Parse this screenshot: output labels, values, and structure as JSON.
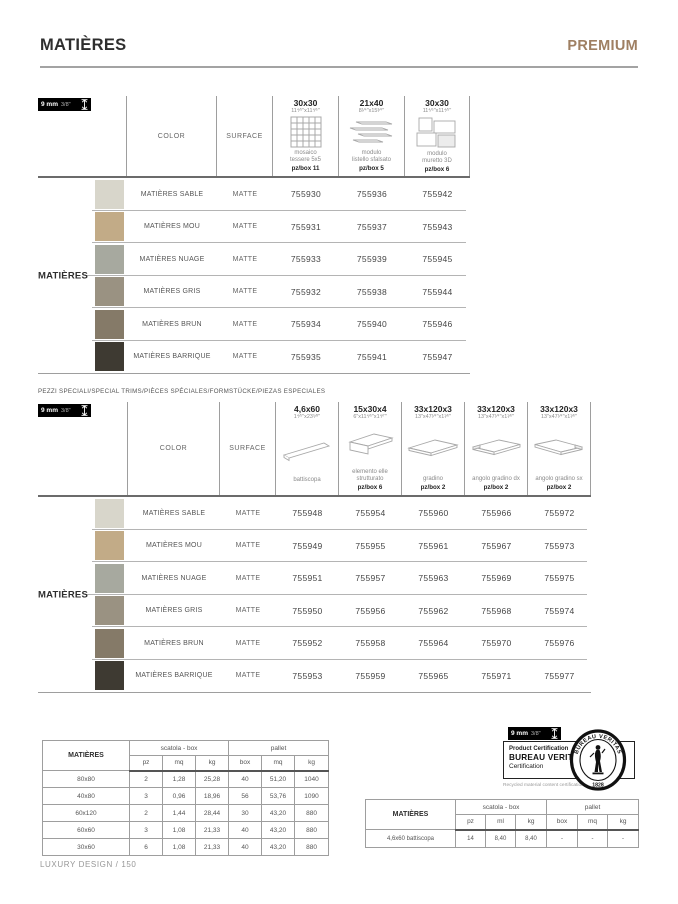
{
  "header": {
    "title": "MATIÈRES",
    "brand": "PREMIUM"
  },
  "colors": {
    "brand": "#9f7f62",
    "title": "#2e2e2e"
  },
  "thickness_badge": {
    "mm": "9 mm",
    "inches": "3/8\""
  },
  "table1": {
    "color_header": "COLOR",
    "surface_header": "SURFACE",
    "side_label": "MATIÈRES",
    "formats": [
      {
        "size": "30x30",
        "inches": "11⁴⁄⁵\"x11⁴⁄⁵\"",
        "label": "mosaico\ntessere 5x5",
        "pzbox": "pz/box 11"
      },
      {
        "size": "21x40",
        "inches": "8¹⁄⁴\"x15³⁄⁴\"",
        "label": "modulo\nlistello sfalsato",
        "pzbox": "pz/box 5"
      },
      {
        "size": "30x30",
        "inches": "11⁴⁄⁵\"x11⁴⁄⁵\"",
        "label": "modulo\nmuretto 3D",
        "pzbox": "pz/box 6"
      }
    ],
    "rows": [
      {
        "color": "MATIÈRES SABLE",
        "surface": "MATTE",
        "swatch": "#d8d6cb",
        "codes": [
          "755930",
          "755936",
          "755942"
        ]
      },
      {
        "color": "MATIÈRES MOU",
        "surface": "MATTE",
        "swatch": "#c2ab87",
        "codes": [
          "755931",
          "755937",
          "755943"
        ]
      },
      {
        "color": "MATIÈRES NUAGE",
        "surface": "MATTE",
        "swatch": "#a7a99f",
        "codes": [
          "755933",
          "755939",
          "755945"
        ]
      },
      {
        "color": "MATIÈRES GRIS",
        "surface": "MATTE",
        "swatch": "#9a9282",
        "codes": [
          "755932",
          "755938",
          "755944"
        ]
      },
      {
        "color": "MATIÈRES BRUN",
        "surface": "MATTE",
        "swatch": "#857a68",
        "codes": [
          "755934",
          "755940",
          "755946"
        ]
      },
      {
        "color": "MATIÈRES BARRIQUE",
        "surface": "MATTE",
        "swatch": "#3e3a32",
        "codes": [
          "755935",
          "755941",
          "755947"
        ]
      }
    ]
  },
  "table2": {
    "section_title": "PEZZI SPECIALI/SPECIAL TRIMS/PIÈCES SPÉCIALES/FORMSTÜCKE/PIEZAS ESPECIALES",
    "color_header": "COLOR",
    "surface_header": "SURFACE",
    "side_label": "MATIÈRES",
    "formats": [
      {
        "size": "4,6x60",
        "inches": "1⁴⁄⁵\"x23⁵⁄⁸\"",
        "label": "battiscopa",
        "pzbox": ""
      },
      {
        "size": "15x30x4",
        "inches": "6\"x11⁴⁄⁵\"x1⁴⁄⁷\"",
        "label": "elemento elle\nstrutturato",
        "pzbox": "pz/box 6"
      },
      {
        "size": "33x120x3",
        "inches": "13\"x47¹⁄⁴\"x1¹⁄⁶\"",
        "label": "gradino",
        "pzbox": "pz/box 2"
      },
      {
        "size": "33x120x3",
        "inches": "13\"x47¹⁄⁴\"x1¹⁄⁶\"",
        "label": "angolo gradino dx",
        "pzbox": "pz/box 2"
      },
      {
        "size": "33x120x3",
        "inches": "13\"x47¹⁄⁴\"x1¹⁄⁶\"",
        "label": "angolo gradino sx",
        "pzbox": "pz/box 2"
      }
    ],
    "rows": [
      {
        "color": "MATIÈRES SABLE",
        "surface": "MATTE",
        "swatch": "#d8d6cb",
        "codes": [
          "755948",
          "755954",
          "755960",
          "755966",
          "755972"
        ]
      },
      {
        "color": "MATIÈRES MOU",
        "surface": "MATTE",
        "swatch": "#c2ab87",
        "codes": [
          "755949",
          "755955",
          "755961",
          "755967",
          "755973"
        ]
      },
      {
        "color": "MATIÈRES NUAGE",
        "surface": "MATTE",
        "swatch": "#a7a99f",
        "codes": [
          "755951",
          "755957",
          "755963",
          "755969",
          "755975"
        ]
      },
      {
        "color": "MATIÈRES GRIS",
        "surface": "MATTE",
        "swatch": "#9a9282",
        "codes": [
          "755950",
          "755956",
          "755962",
          "755968",
          "755974"
        ]
      },
      {
        "color": "MATIÈRES BRUN",
        "surface": "MATTE",
        "swatch": "#857a68",
        "codes": [
          "755952",
          "755958",
          "755964",
          "755970",
          "755976"
        ]
      },
      {
        "color": "MATIÈRES BARRIQUE",
        "surface": "MATTE",
        "swatch": "#3e3a32",
        "codes": [
          "755953",
          "755959",
          "755965",
          "755971",
          "755977"
        ]
      }
    ]
  },
  "packing_table_main": {
    "label": "MATIÈRES",
    "group_box": "scatola - box",
    "group_pallet": "pallet",
    "subheaders": [
      "pz",
      "mq",
      "kg",
      "box",
      "mq",
      "kg"
    ],
    "rows": [
      {
        "size": "80x80",
        "values": [
          "2",
          "1,28",
          "25,28",
          "40",
          "51,20",
          "1040"
        ]
      },
      {
        "size": "40x80",
        "values": [
          "3",
          "0,96",
          "18,96",
          "56",
          "53,76",
          "1090"
        ]
      },
      {
        "size": "60x120",
        "values": [
          "2",
          "1,44",
          "28,44",
          "30",
          "43,20",
          "880"
        ]
      },
      {
        "size": "60x60",
        "values": [
          "3",
          "1,08",
          "21,33",
          "40",
          "43,20",
          "880"
        ]
      },
      {
        "size": "30x60",
        "values": [
          "6",
          "1,08",
          "21,33",
          "40",
          "43,20",
          "880"
        ]
      }
    ]
  },
  "packing_table_trims": {
    "label": "MATIÈRES",
    "group_box": "scatola - box",
    "group_pallet": "pallet",
    "subheaders": [
      "pz",
      "ml",
      "kg",
      "box",
      "mq",
      "kg"
    ],
    "rows": [
      {
        "size": "4,6x60 battiscopa",
        "values": [
          "14",
          "8,40",
          "8,40",
          "-",
          "-",
          "-"
        ]
      }
    ]
  },
  "certification": {
    "line1": "Product Certification",
    "line2": "BUREAU VERITAS",
    "line3": "Certification",
    "note": "Recycled material content certification",
    "logo_top": "BUREAU VERITAS",
    "logo_year": "1828"
  },
  "footer": "LUXURY DESIGN / 150"
}
